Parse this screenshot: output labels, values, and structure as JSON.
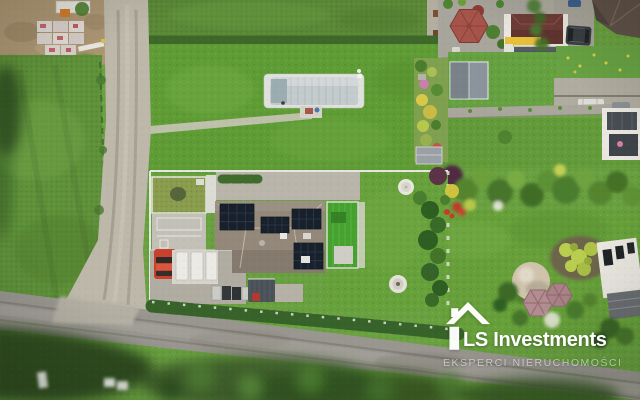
{
  "meta": {
    "kind": "aerial-drone-photo",
    "subject": "Aerial view of a modern single-family house with rooftop solar panels, paved driveway with red car, artificial-turf terrace, lawns, covered pool on the neighbouring plot, gardens, gazebos and a rural road junction"
  },
  "watermark": {
    "brand": "LS Investments",
    "tagline": "EKSPERCI NIERUCHOMOŚCI",
    "icon": "house-logo-icon",
    "text_color": "#ffffff",
    "tagline_opacity": "0.55"
  },
  "palette": {
    "lawn_green": "#69a040",
    "lawn_bright": "#5f9c35",
    "meadow_green": "#5a8836",
    "hedge_green": "#37632a",
    "asphalt_road": "#999690",
    "gravel_road": "#bdb8aa",
    "dirt_ground": "#ab9573",
    "roof_taupe": "#94887b",
    "solar_panel": "#18202b",
    "turf_green": "#46a22e",
    "pool_cover": "#c3cbcd",
    "red_car": "#c8402e",
    "suv_dark": "#383e42",
    "gazebo_red": "#a6544a",
    "house_yellow": "#e6bf3b",
    "brown_roof": "#5f5148",
    "dome_beige": "#cfc3ab",
    "gazebo_mauve": "#b18c90",
    "white_building": "#e9e7e0"
  }
}
